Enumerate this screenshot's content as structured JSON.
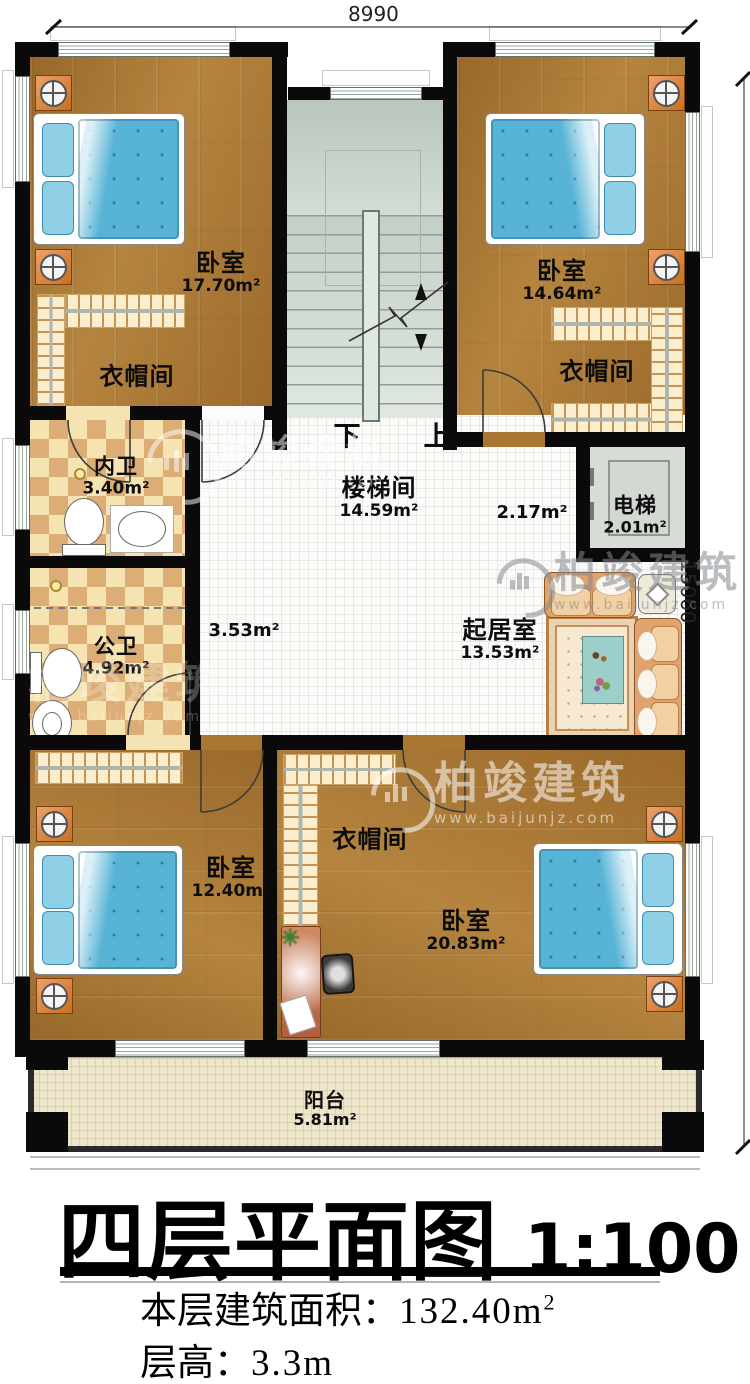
{
  "dimensions": {
    "top": "8990",
    "right": "15060"
  },
  "stairs": {
    "down": "下",
    "up": "上"
  },
  "rooms": {
    "bedroom_tl": {
      "name": "卧室",
      "area": "17.70m²"
    },
    "closet_tl": {
      "name": "衣帽间"
    },
    "bath_inner": {
      "name": "内卫",
      "area": "3.40m²"
    },
    "bath_public": {
      "name": "公卫",
      "area": "4.92m²"
    },
    "stairwell": {
      "name": "楼梯间",
      "area": "14.59m²"
    },
    "corridor_left": {
      "area": "3.53m²"
    },
    "corridor_right": {
      "area": "2.17m²"
    },
    "bedroom_tr": {
      "name": "卧室",
      "area": "14.64m²"
    },
    "closet_tr": {
      "name": "衣帽间"
    },
    "elevator": {
      "name": "电梯",
      "area": "2.01m²"
    },
    "living": {
      "name": "起居室",
      "area": "13.53m²"
    },
    "bedroom_bl": {
      "name": "卧室",
      "area": "12.40m²"
    },
    "closet_b": {
      "name": "衣帽间"
    },
    "bedroom_br": {
      "name": "卧室",
      "area": "20.83m²"
    },
    "balcony": {
      "name": "阳台",
      "area": "5.81m²"
    }
  },
  "title": {
    "main": "四层平面图",
    "scale": "1:100"
  },
  "notes": {
    "area_label": "本层建筑面积：",
    "area_value": "132.40m",
    "area_sup": "2",
    "height_label": "层高：",
    "height_value": "3.3m"
  },
  "watermark": {
    "brand": "柏竣建筑",
    "url": "www.baijunjz.com"
  },
  "colors": {
    "wall": "#0a0a0a",
    "wood": "#a97733",
    "bed": "#58b4d6",
    "checker_dark": "#dcae76"
  }
}
